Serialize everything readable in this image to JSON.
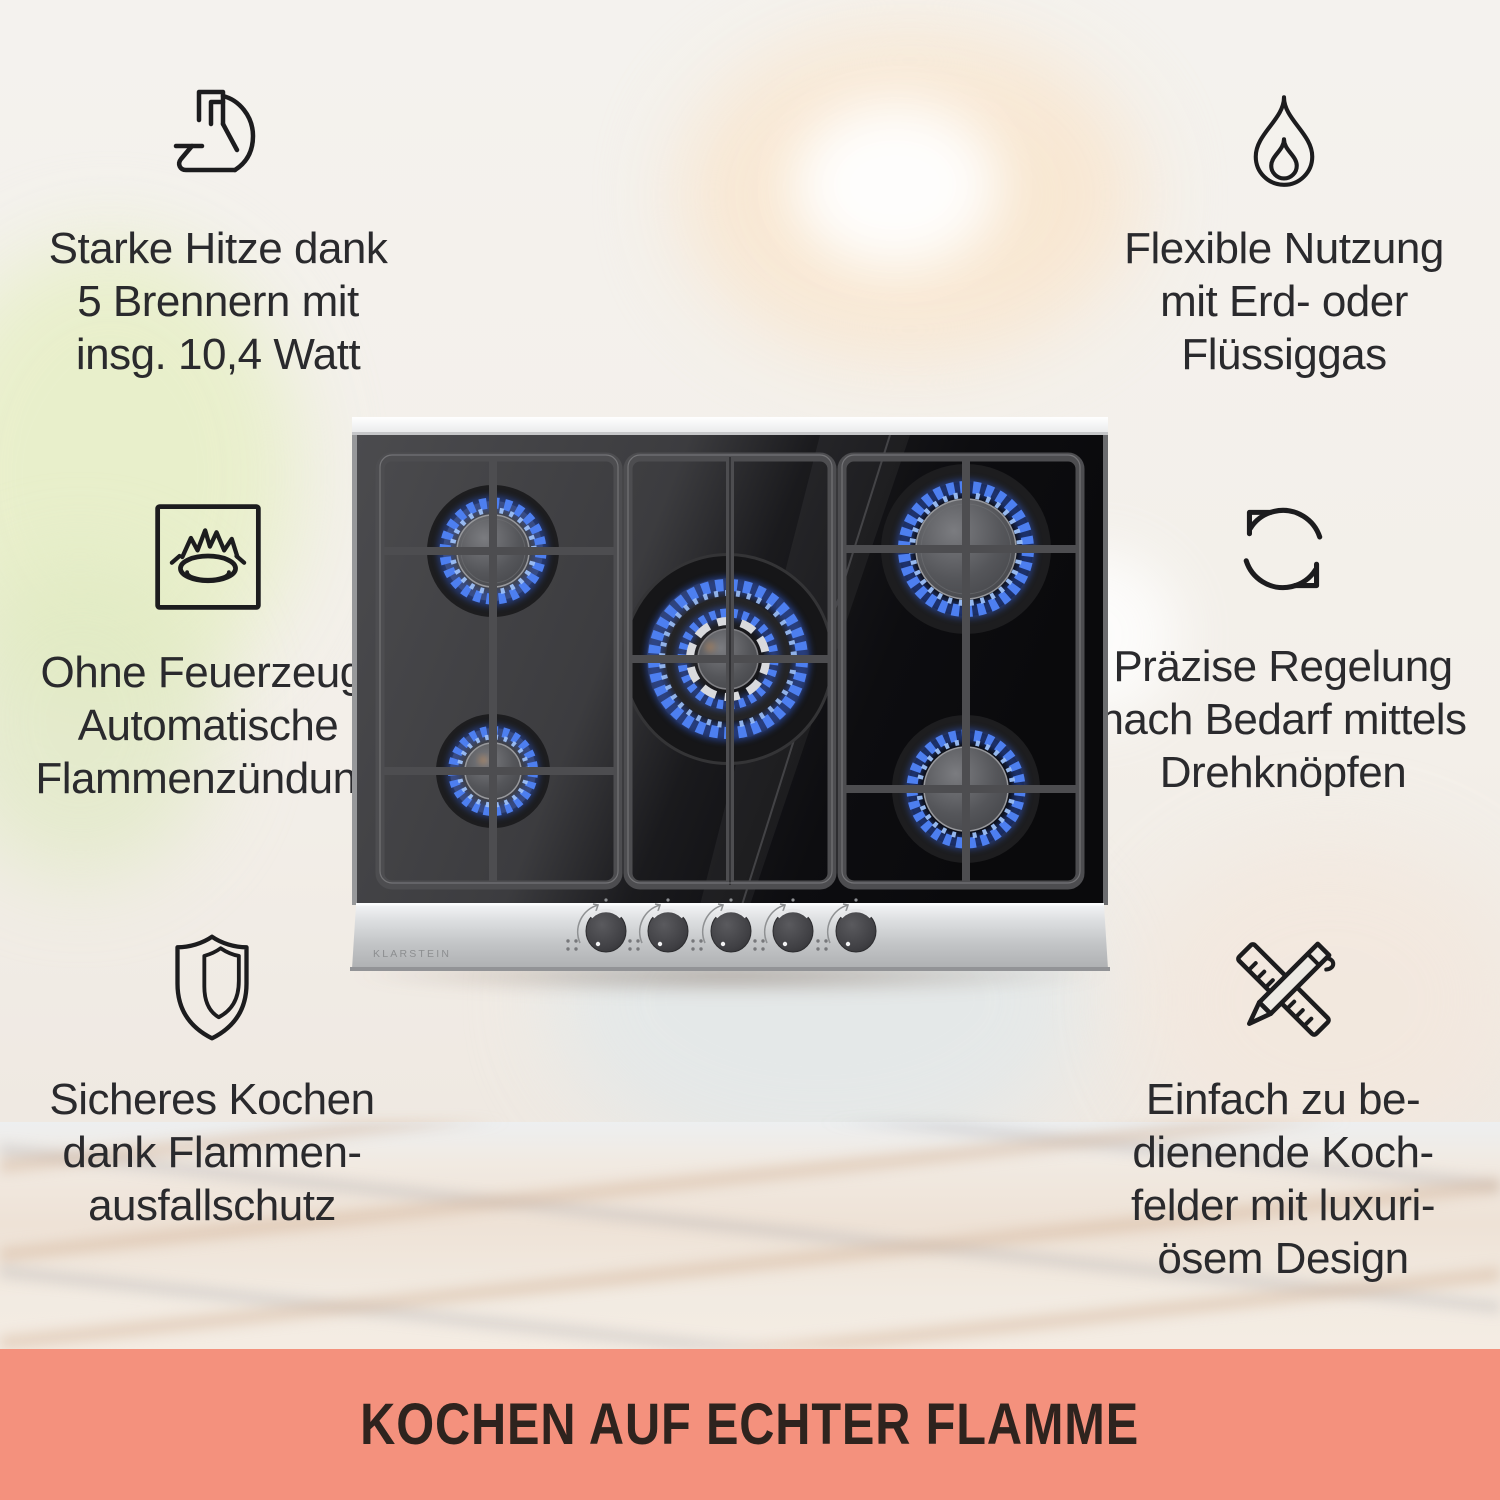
{
  "banner": {
    "title": "KOCHEN AUF ECHTER FLAMME"
  },
  "features": [
    {
      "id": "strong-heat",
      "icon": "muscle-arm-icon",
      "lines": [
        "Starke Hitze dank",
        "5 Brennern mit",
        "insg. 10,4 Watt"
      ]
    },
    {
      "id": "flexible-gas",
      "icon": "flame-icon",
      "lines": [
        "Flexible Nutzung",
        "mit Erd- oder",
        "Flüssiggas"
      ]
    },
    {
      "id": "auto-ignition",
      "icon": "burner-ignition-icon",
      "lines": [
        "Ohne Feuerzeug:",
        "Automatische",
        "Flammenzündung"
      ]
    },
    {
      "id": "precise-control",
      "icon": "rotate-arrows-icon",
      "lines": [
        "Präzise Regelung",
        "nach Bedarf mittels",
        "Drehknöpfen"
      ]
    },
    {
      "id": "safe-cooking",
      "icon": "shield-icon",
      "lines": [
        "Sicheres Kochen",
        "dank Flammen-",
        "ausfallschutz"
      ]
    },
    {
      "id": "easy-design",
      "icon": "ruler-pencil-icon",
      "lines": [
        "Einfach zu be-",
        "dienende Koch-",
        "felder mit luxuri-",
        "ösem Design"
      ]
    }
  ],
  "product": {
    "brand": "KLARSTEIN",
    "burner_count": 5,
    "knob_count": 5
  },
  "colors": {
    "banner_bg": "#F4917D",
    "banner_text": "#2E231E",
    "feature_text": "#2A2A2D",
    "icon_stroke": "#1C1C1E",
    "flame_blue": "#4D7FF0",
    "flame_glow": "#2E57C8",
    "flame_inner": "#9CC0F8",
    "steel_panel": "#C9CACC",
    "glass_dark": "#0B0B0D"
  }
}
